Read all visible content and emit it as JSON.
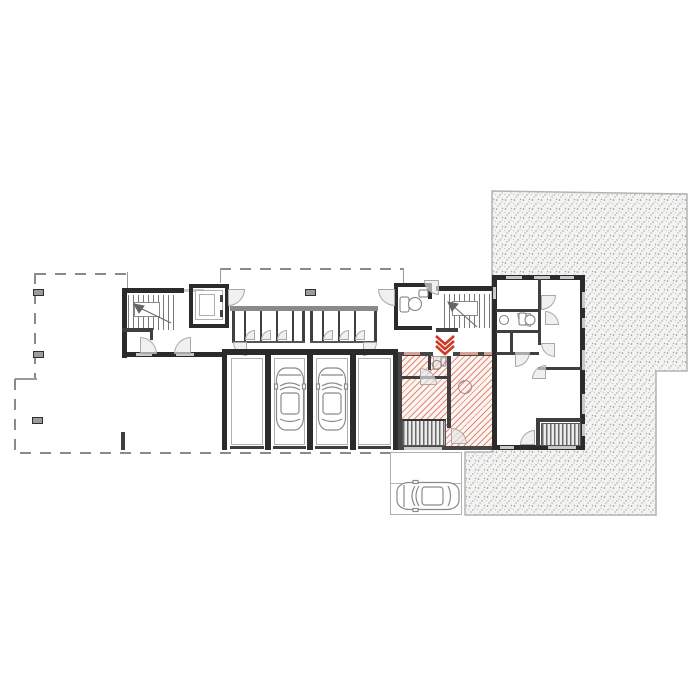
{
  "document": {
    "kind": "architectural-floor-plan",
    "text_labels": [],
    "highlighted_unit": {
      "style": "red-diagonal-hatch",
      "entrance_marker": "red-double-chevron-pointing-down",
      "rooms_visible": 2,
      "has_internal_stairs": true,
      "has_bathroom": true
    },
    "garage": {
      "bay_count": 4,
      "cars_parked_inside": 2
    },
    "outdoor_parking": {
      "spaces": 2,
      "cars_parked": 1
    },
    "stair_cores": 2,
    "elevators": 1,
    "wc_rooms": 1,
    "storage_compartment_groups": 2,
    "dashed_outline_area": {
      "columns_marked": 4,
      "style": "dashed-boundary"
    },
    "ground_texture": "stippled-gravel",
    "right_building": {
      "has_stairs": true,
      "door_arcs": true,
      "windows": true
    }
  },
  "colors": {
    "paper": "#ffffff",
    "wall": "#2b2b2b",
    "interior_wall": "#3f3f3f",
    "thin_line": "#9a9a9a",
    "window_line": "#c9c9c9",
    "dash_line": "#8a8a8a",
    "hatch_line": "#e08873",
    "hatch_bg": "#fdf5f2",
    "accent_red": "#cf3a27",
    "stipple_bg": "#f3f3f2",
    "stipple_dot": "#8f8f8f",
    "arc_fill": "rgba(232,232,232,0.65)",
    "car_line": "#8a8a8a"
  }
}
